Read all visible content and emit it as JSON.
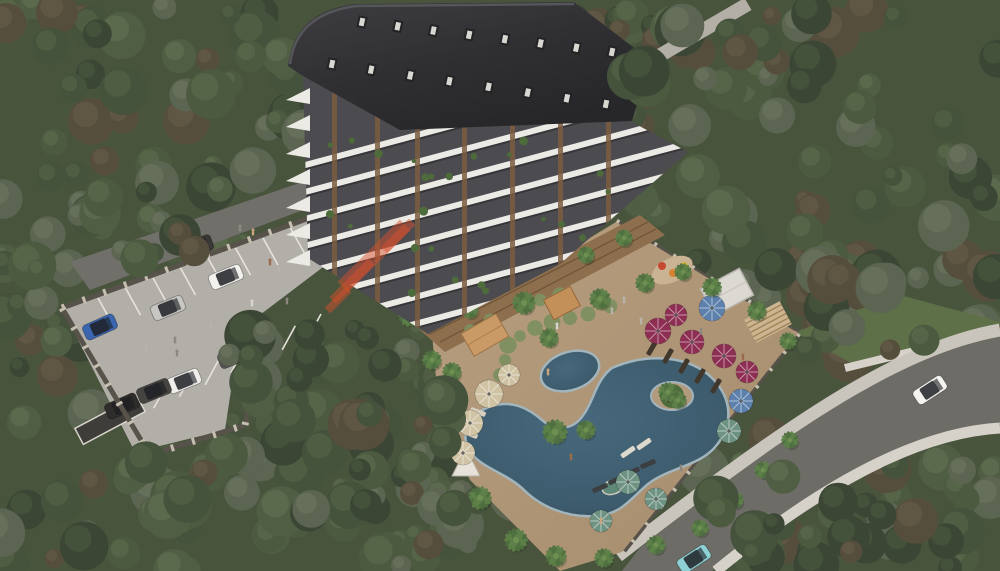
{
  "meta": {
    "description": "Aerial 3D architectural rendering of a residential apartment complex with swimming pool, amenity deck, parking lot, perimeter roads and surrounding forest",
    "render_type": "architectural-visualization"
  },
  "palette": {
    "forest_base": "#49543d",
    "road": "#716f6a",
    "road_right": "#6e6c67",
    "sidewalk": "#c9c5bd",
    "wall_light": "#d6d2ca",
    "parking": "#b2afa9",
    "stall_line": "#e6e3dc",
    "grass": "#5e7048",
    "roof_dark": "#343437",
    "facade_dark": "#4b4b50",
    "facade_white": "#eceae5",
    "wood_slat": "#7b5d3f",
    "terrace_wood": "#8d6f4e",
    "deck_tan": "#b29a7c",
    "pool_water": "#3d5c6e",
    "pool_water_deep": "#31495a",
    "pool_edge": "#a2b5bc",
    "island_green": "#4e6b3b",
    "shrub": "#7e8f60",
    "umbrella_maroon": "#8e2e52",
    "umbrella_teal": "#6f9383",
    "umbrella_beige": "#cfc3a4",
    "umbrella_blue": "#5d80ad",
    "canopy_white": "#e7e3da",
    "jacuzzi": "#5f8878",
    "fence_dark": "#57524a",
    "fence_post": "#c6bfb0",
    "watermark_orange": "#d7502b"
  },
  "forest": {
    "variants": [
      {
        "b": "#3b4634",
        "h": "#4d5a41"
      },
      {
        "b": "#45523c",
        "h": "#576648"
      },
      {
        "b": "#505e44",
        "h": "#627252"
      },
      {
        "b": "#4c5a40",
        "h": "#5e6d4e"
      },
      {
        "b": "#564e3d",
        "h": "#665c48"
      },
      {
        "b": "#5c6551",
        "h": "#6d7660"
      }
    ],
    "regions": [
      {
        "x": 0,
        "y": 0,
        "w": 310,
        "h": 270,
        "n": 55
      },
      {
        "x": 555,
        "y": 0,
        "w": 150,
        "h": 60,
        "n": 10
      },
      {
        "x": 620,
        "y": 0,
        "w": 380,
        "h": 340,
        "n": 75
      },
      {
        "x": 0,
        "y": 330,
        "w": 460,
        "h": 241,
        "n": 60
      },
      {
        "x": 330,
        "y": 440,
        "w": 200,
        "h": 131,
        "n": 25
      },
      {
        "x": 690,
        "y": 430,
        "w": 310,
        "h": 141,
        "n": 35
      },
      {
        "x": 790,
        "y": 250,
        "w": 210,
        "h": 110,
        "n": 20
      },
      {
        "x": 0,
        "y": 260,
        "w": 60,
        "h": 90,
        "n": 10
      }
    ],
    "overlays": [
      {
        "x": 295,
        "y": 330,
        "w": 160,
        "h": 185,
        "n": 26
      },
      {
        "x": 225,
        "y": 325,
        "w": 85,
        "h": 100,
        "n": 12
      },
      {
        "x": 55,
        "y": 185,
        "w": 140,
        "h": 95,
        "n": 12
      },
      {
        "x": 630,
        "y": 0,
        "w": 150,
        "h": 85,
        "n": 12
      },
      {
        "x": 800,
        "y": 275,
        "w": 185,
        "h": 95,
        "n": 12
      },
      {
        "x": 710,
        "y": 470,
        "w": 230,
        "h": 101,
        "n": 14
      },
      {
        "x": 60,
        "y": 440,
        "w": 160,
        "h": 120,
        "n": 10
      }
    ]
  },
  "parking": {
    "cars": [
      {
        "x": 226,
        "y": 277,
        "a": -22,
        "c": "#f2f1ee"
      },
      {
        "x": 168,
        "y": 308,
        "a": -22,
        "c": "#c8c7c4"
      },
      {
        "x": 100,
        "y": 327,
        "a": -24,
        "c": "#3a66b0"
      },
      {
        "x": 235,
        "y": 356,
        "a": -22,
        "c": "#55534f"
      },
      {
        "x": 184,
        "y": 381,
        "a": -22,
        "c": "#efeeea"
      },
      {
        "x": 154,
        "y": 391,
        "a": -22,
        "c": "#454441"
      },
      {
        "x": 122,
        "y": 406,
        "a": -24,
        "c": "#2e2d2b"
      },
      {
        "x": 196,
        "y": 247,
        "a": -20,
        "c": "#3a3936"
      }
    ],
    "stall_rows": [
      {
        "x0": 98,
        "y0": 298,
        "x1": 318,
        "y1": 218,
        "n": 9,
        "dx": 15,
        "dy": 27
      },
      {
        "x0": 128,
        "y0": 420,
        "x1": 308,
        "y1": 338,
        "n": 8,
        "dx": 13,
        "dy": -24
      }
    ],
    "people": [
      [
        270,
        262
      ],
      [
        279,
        270
      ],
      [
        244,
        325
      ],
      [
        211,
        326
      ],
      [
        175,
        340
      ],
      [
        177,
        353
      ],
      [
        146,
        347
      ],
      [
        242,
        358
      ],
      [
        287,
        301
      ],
      [
        252,
        303
      ],
      [
        240,
        228
      ],
      [
        253,
        232
      ],
      [
        318,
        207
      ]
    ]
  },
  "road_right": {
    "cars": [
      {
        "x": 930,
        "y": 390,
        "a": -33,
        "c": "#f4f3f0"
      },
      {
        "x": 694,
        "y": 559,
        "a": -33,
        "c": "#8fd0d4"
      }
    ]
  },
  "building": {
    "floors": 11,
    "band_step": 26,
    "slats_x": [
      332,
      375,
      415,
      462,
      510,
      558,
      606
    ],
    "wedges": {
      "n": 7,
      "y0": 88,
      "step": 27
    },
    "dormer_rows": [
      {
        "x0": 362,
        "y0": 22,
        "x1": 612,
        "y1": 52,
        "n": 8
      },
      {
        "x0": 332,
        "y0": 64,
        "x1": 606,
        "y1": 104,
        "n": 8
      }
    ],
    "plants_n": 30
  },
  "pool_area": {
    "umbrellas": [
      {
        "x": 658,
        "y": 331,
        "r": 13,
        "c": "umbrella_maroon"
      },
      {
        "x": 692,
        "y": 342,
        "r": 12,
        "c": "umbrella_maroon"
      },
      {
        "x": 724,
        "y": 356,
        "r": 12,
        "c": "umbrella_maroon"
      },
      {
        "x": 747,
        "y": 372,
        "r": 11,
        "c": "umbrella_maroon"
      },
      {
        "x": 676,
        "y": 315,
        "r": 11,
        "c": "umbrella_maroon"
      },
      {
        "x": 712,
        "y": 308,
        "r": 13,
        "c": "umbrella_blue"
      },
      {
        "x": 741,
        "y": 401,
        "r": 12,
        "c": "umbrella_blue"
      },
      {
        "x": 489,
        "y": 394,
        "r": 14,
        "c": "umbrella_beige"
      },
      {
        "x": 470,
        "y": 423,
        "r": 13,
        "c": "umbrella_beige"
      },
      {
        "x": 463,
        "y": 453,
        "r": 12,
        "c": "umbrella_beige"
      },
      {
        "x": 509,
        "y": 375,
        "r": 11,
        "c": "umbrella_beige"
      },
      {
        "x": 729,
        "y": 431,
        "r": 12,
        "c": "umbrella_teal"
      },
      {
        "x": 628,
        "y": 482,
        "r": 12,
        "c": "umbrella_teal"
      },
      {
        "x": 656,
        "y": 499,
        "r": 11,
        "c": "umbrella_teal"
      },
      {
        "x": 601,
        "y": 521,
        "r": 11,
        "c": "umbrella_teal"
      }
    ],
    "loungers": [
      {
        "x": 652,
        "y": 348,
        "a": -60,
        "c": "#41372c"
      },
      {
        "x": 668,
        "y": 356,
        "a": -60,
        "c": "#41372c"
      },
      {
        "x": 684,
        "y": 366,
        "a": -60,
        "c": "#41372c"
      },
      {
        "x": 700,
        "y": 376,
        "a": -60,
        "c": "#41372c"
      },
      {
        "x": 716,
        "y": 386,
        "a": -60,
        "c": "#41372c"
      },
      {
        "x": 600,
        "y": 488,
        "a": -24,
        "c": "#3c3f42"
      },
      {
        "x": 616,
        "y": 480,
        "a": -24,
        "c": "#3c3f42"
      },
      {
        "x": 632,
        "y": 472,
        "a": -24,
        "c": "#3c3f42"
      },
      {
        "x": 648,
        "y": 464,
        "a": -24,
        "c": "#3c3f42"
      },
      {
        "x": 628,
        "y": 452,
        "a": -35,
        "c": "#ded9cf"
      },
      {
        "x": 644,
        "y": 444,
        "a": -35,
        "c": "#ded9cf"
      },
      {
        "x": 478,
        "y": 412,
        "a": 20,
        "c": "#d8cfc0"
      },
      {
        "x": 470,
        "y": 434,
        "a": 20,
        "c": "#d8cfc0"
      },
      {
        "x": 464,
        "y": 456,
        "a": 20,
        "c": "#d8cfc0"
      }
    ],
    "palms": [
      [
        668,
        392,
        10
      ],
      [
        678,
        400,
        9
      ],
      [
        524,
        303,
        12
      ],
      [
        549,
        338,
        10
      ],
      [
        600,
        299,
        11
      ],
      [
        645,
        283,
        10
      ],
      [
        683,
        272,
        9
      ],
      [
        712,
        287,
        10
      ],
      [
        757,
        311,
        10
      ],
      [
        788,
        341,
        9
      ],
      [
        555,
        432,
        13
      ],
      [
        586,
        430,
        10
      ],
      [
        452,
        372,
        10
      ],
      [
        448,
        402,
        9
      ],
      [
        480,
        498,
        12
      ],
      [
        516,
        540,
        12
      ],
      [
        556,
        556,
        11
      ],
      [
        604,
        558,
        10
      ],
      [
        656,
        545,
        10
      ],
      [
        700,
        528,
        9
      ],
      [
        735,
        500,
        9
      ],
      [
        763,
        470,
        9
      ],
      [
        790,
        440,
        9
      ],
      [
        624,
        238,
        9
      ],
      [
        586,
        255,
        9
      ],
      [
        470,
        310,
        9
      ],
      [
        432,
        360,
        10
      ],
      [
        393,
        85,
        12
      ],
      [
        410,
        315,
        12
      ]
    ],
    "shrubs": [
      [
        508,
        345
      ],
      [
        520,
        336
      ],
      [
        535,
        328
      ],
      [
        552,
        322
      ],
      [
        570,
        318
      ],
      [
        588,
        314
      ],
      [
        540,
        300
      ],
      [
        560,
        295
      ],
      [
        610,
        306
      ],
      [
        505,
        360
      ],
      [
        500,
        375
      ],
      [
        470,
        330
      ],
      [
        490,
        320
      ]
    ],
    "people": [
      [
        557,
        326
      ],
      [
        612,
        311
      ],
      [
        641,
        321
      ],
      [
        701,
        331
      ],
      [
        743,
        357
      ],
      [
        571,
        457
      ],
      [
        601,
        521
      ],
      [
        681,
        468
      ],
      [
        548,
        372
      ],
      [
        624,
        300
      ]
    ],
    "playground_colors": [
      "#c64a32",
      "#d98231",
      "#d9b43a"
    ]
  },
  "watermark": {
    "stripes": [
      {
        "x": 374,
        "y": 256,
        "w": 88,
        "h": 15
      },
      {
        "x": 352,
        "y": 281,
        "w": 55,
        "h": 9
      },
      {
        "x": 398,
        "y": 236,
        "w": 40,
        "h": 9
      },
      {
        "x": 338,
        "y": 300,
        "w": 30,
        "h": 8
      }
    ],
    "opacity": 0.48,
    "angle": -45
  }
}
